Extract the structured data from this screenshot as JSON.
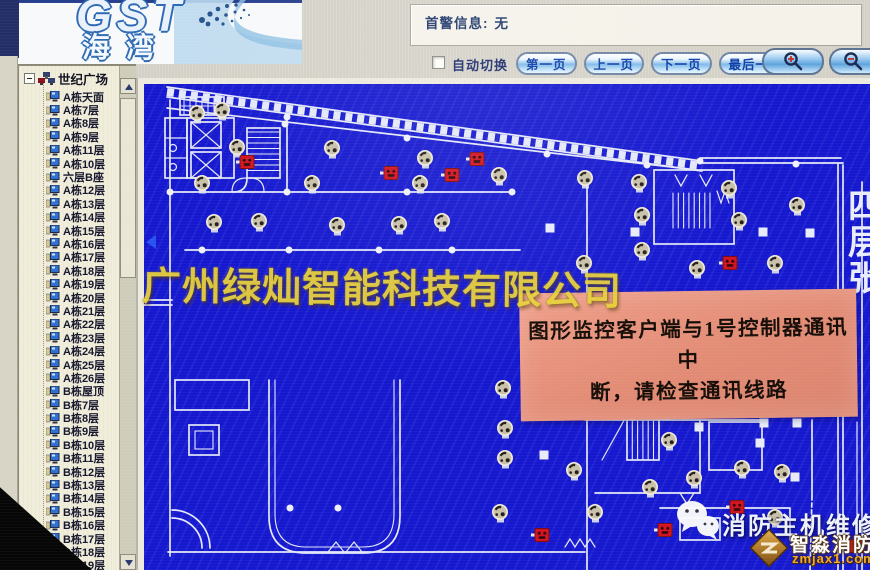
{
  "header": {
    "logo": {
      "brand": "GST",
      "brand_cn": "海湾"
    },
    "alarm_panel": {
      "label": "首警信息:",
      "value": "无"
    },
    "toolbar": {
      "auto_switch_label": "自动切换",
      "auto_switch_checked": false,
      "buttons": [
        {
          "label": "第一页"
        },
        {
          "label": "上一页"
        },
        {
          "label": "下一页"
        },
        {
          "label": "最后一页"
        }
      ],
      "zoom_in_icon": "magnifier-plus",
      "zoom_out_icon": "magnifier-minus"
    }
  },
  "sidebar": {
    "root": "世纪广场",
    "items": [
      "A栋天面",
      "A栋7层",
      "A栋8层",
      "A栋9层",
      "A栋11层",
      "A栋10层",
      "六层B座",
      "A栋12层",
      "A栋13层",
      "A栋14层",
      "A栋15层",
      "A栋16层",
      "A栋17层",
      "A栋18层",
      "A栋19层",
      "A栋20层",
      "A栋21层",
      "A栋22层",
      "A栋23层",
      "A栋24层",
      "A栋25层",
      "A栋26层",
      "B栋屋顶",
      "B栋7层",
      "B栋8层",
      "B栋9层",
      "B栋10层",
      "B栋11层",
      "B栋12层",
      "B栋13层",
      "B栋14层",
      "B栋15层",
      "B栋16层",
      "B栋17层",
      "B栋18层",
      "B栋19层",
      "B栋20层"
    ]
  },
  "map": {
    "edge_label": "四层张",
    "colors": {
      "background": "#1518cf",
      "lines": "#e4e8f8",
      "detector": "#c9c0a9",
      "alarm": "#d21420"
    },
    "detectors": [
      [
        53,
        29
      ],
      [
        78,
        26
      ],
      [
        93,
        63
      ],
      [
        188,
        64
      ],
      [
        281,
        74
      ],
      [
        355,
        91
      ],
      [
        58,
        99
      ],
      [
        168,
        99
      ],
      [
        276,
        99
      ],
      [
        70,
        138
      ],
      [
        115,
        137
      ],
      [
        193,
        141
      ],
      [
        255,
        140
      ],
      [
        298,
        137
      ],
      [
        441,
        94
      ],
      [
        495,
        98
      ],
      [
        585,
        104
      ],
      [
        653,
        121
      ],
      [
        595,
        136
      ],
      [
        498,
        131
      ],
      [
        498,
        166
      ],
      [
        440,
        179
      ],
      [
        553,
        184
      ],
      [
        631,
        179
      ],
      [
        359,
        304
      ],
      [
        361,
        344
      ],
      [
        361,
        374
      ],
      [
        356,
        428
      ],
      [
        525,
        356
      ],
      [
        550,
        394
      ],
      [
        506,
        403
      ],
      [
        598,
        384
      ],
      [
        638,
        388
      ],
      [
        631,
        433
      ],
      [
        430,
        386
      ],
      [
        451,
        428
      ]
    ],
    "alarms": [
      [
        103,
        78
      ],
      [
        247,
        89
      ],
      [
        308,
        91
      ],
      [
        333,
        75
      ],
      [
        586,
        179
      ],
      [
        593,
        423
      ],
      [
        521,
        446
      ],
      [
        398,
        451
      ],
      [
        713,
        462
      ]
    ]
  },
  "alert": {
    "line1": "图形监控客户端与1号控制器通讯中",
    "line2": "断，请检查通讯线路",
    "background": "#e38f7b"
  },
  "watermarks": {
    "company": "广州绿灿智能科技有限公司",
    "service": "消防主机维修",
    "logo_text": "智淼消防",
    "logo_domain": "zmjax1.com"
  }
}
